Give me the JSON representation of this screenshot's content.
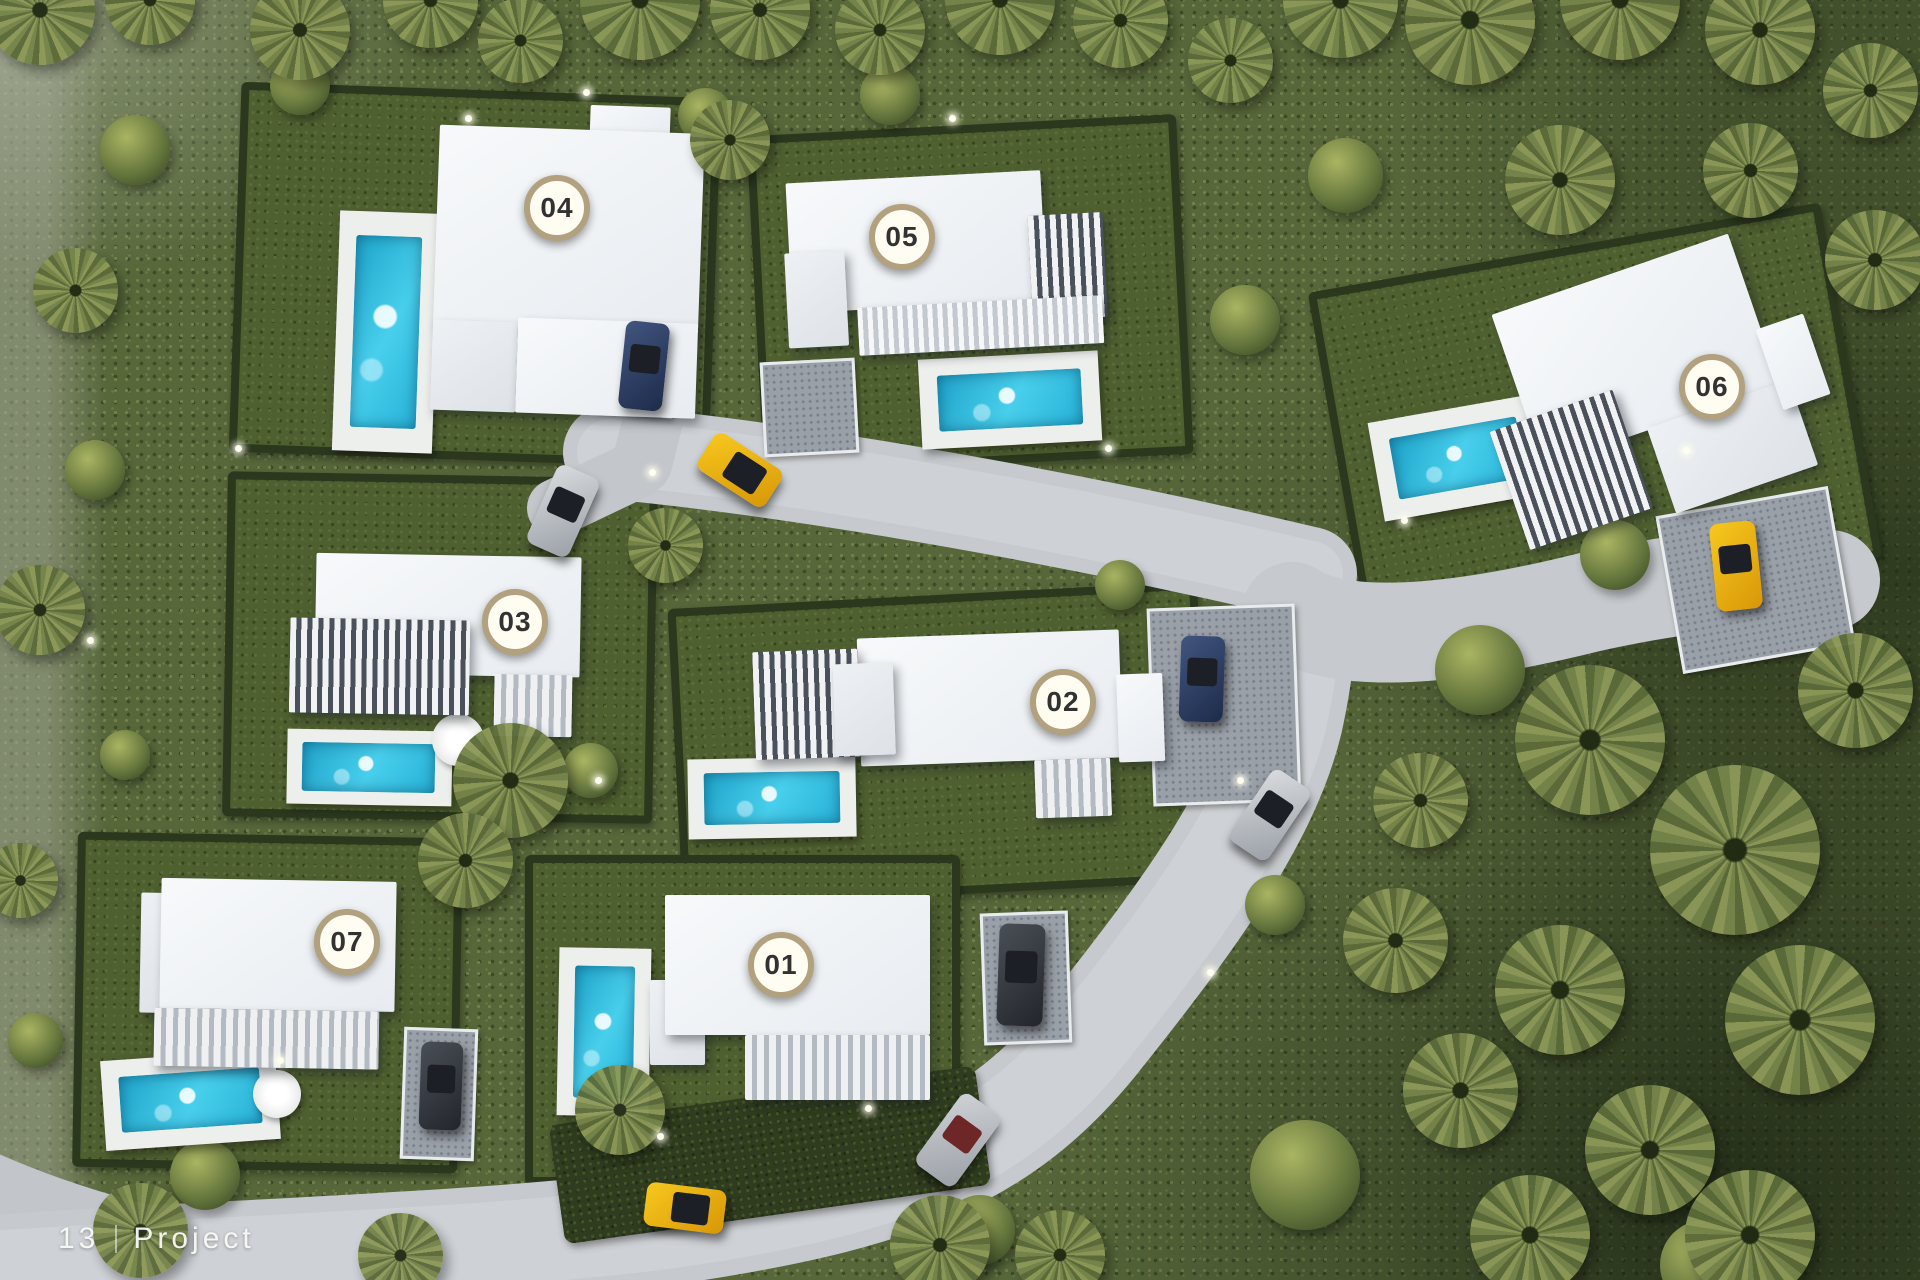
{
  "footer": {
    "page_number": "13",
    "section_label": "Project"
  },
  "markers": [
    {
      "label": "01"
    },
    {
      "label": "02"
    },
    {
      "label": "03"
    },
    {
      "label": "04"
    },
    {
      "label": "05"
    },
    {
      "label": "06"
    },
    {
      "label": "07"
    }
  ],
  "scene": {
    "type": "aerial-site-plan",
    "description": "Top-down 3D render of a development with seven white villas, each with a private pool and garden, linked by a curving grey access road through dense palm woodland.",
    "villa_count": 7
  },
  "colors": {
    "marker_ring": "#b2a17e",
    "marker_fill": "#fffdf2",
    "marker_text": "#323232",
    "pool_water": "#2fc0e4",
    "road": "#c6c9cd",
    "villa_white": "#f2f4f6",
    "lawn_green": "#4f6030",
    "hedge_green": "#2b381e",
    "car_yellow": "#e9ab10",
    "car_blue": "#2e3f63",
    "car_silver": "#c3c6ca",
    "car_dark": "#34383f",
    "footer_text": "#f5f5f5"
  }
}
